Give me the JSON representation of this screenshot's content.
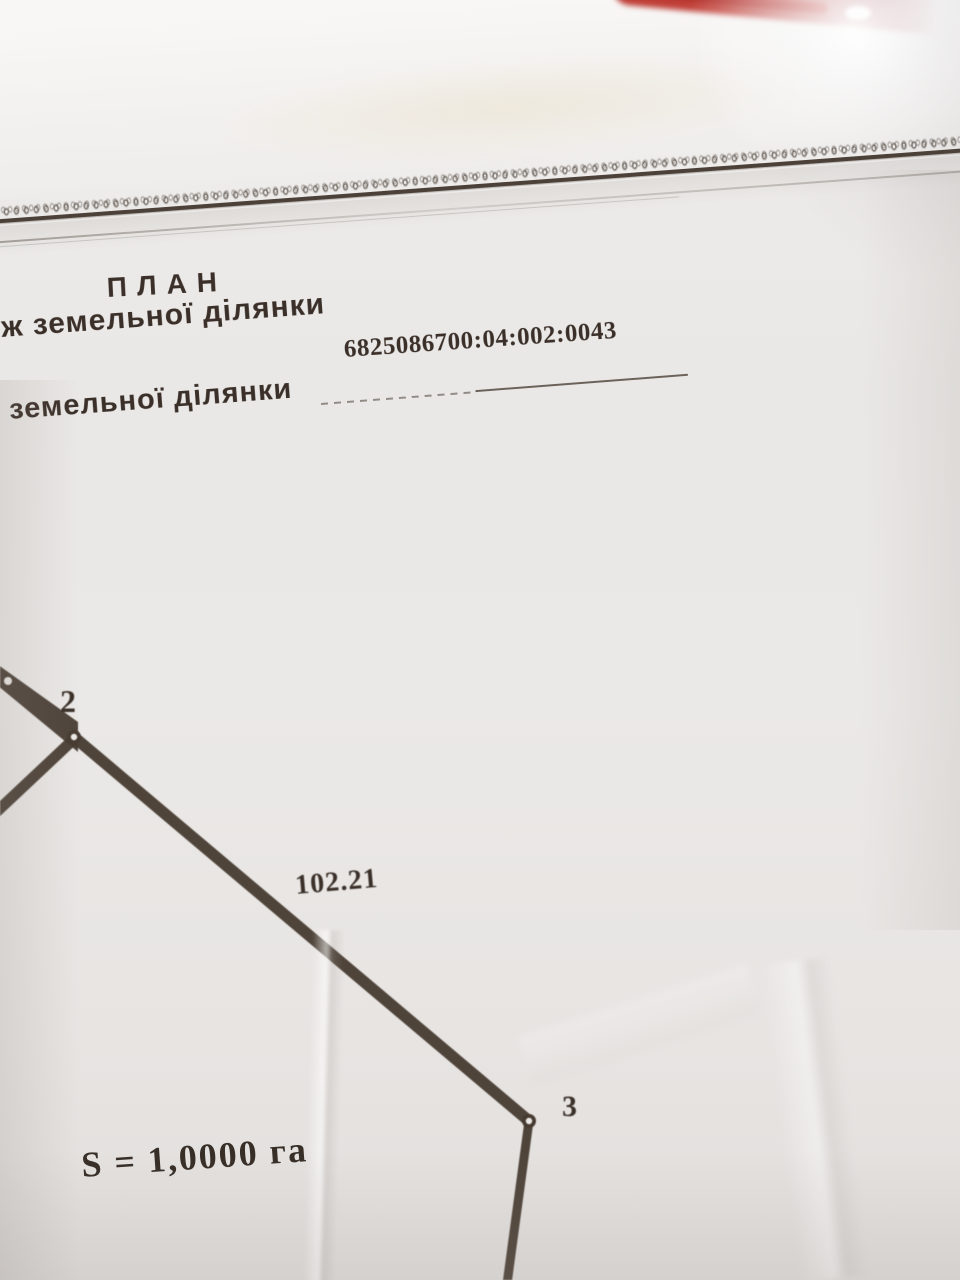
{
  "colors": {
    "paper": "#eae8e6",
    "ink_text": "#3b3029",
    "ink_line": "#473b31",
    "red_object": "#bd3a33"
  },
  "header": {
    "title": "ПЛАН",
    "subtitle_fragment": "ж земельної ділянки",
    "cadastral_number": "6825086700:04:002:0043",
    "field_label": "земельної ділянки"
  },
  "plot_diagram": {
    "vertices": [
      {
        "label": "2"
      },
      {
        "label": "3"
      }
    ],
    "edge_length_label": "102.21",
    "area_label": "S = 1,0000 га"
  }
}
